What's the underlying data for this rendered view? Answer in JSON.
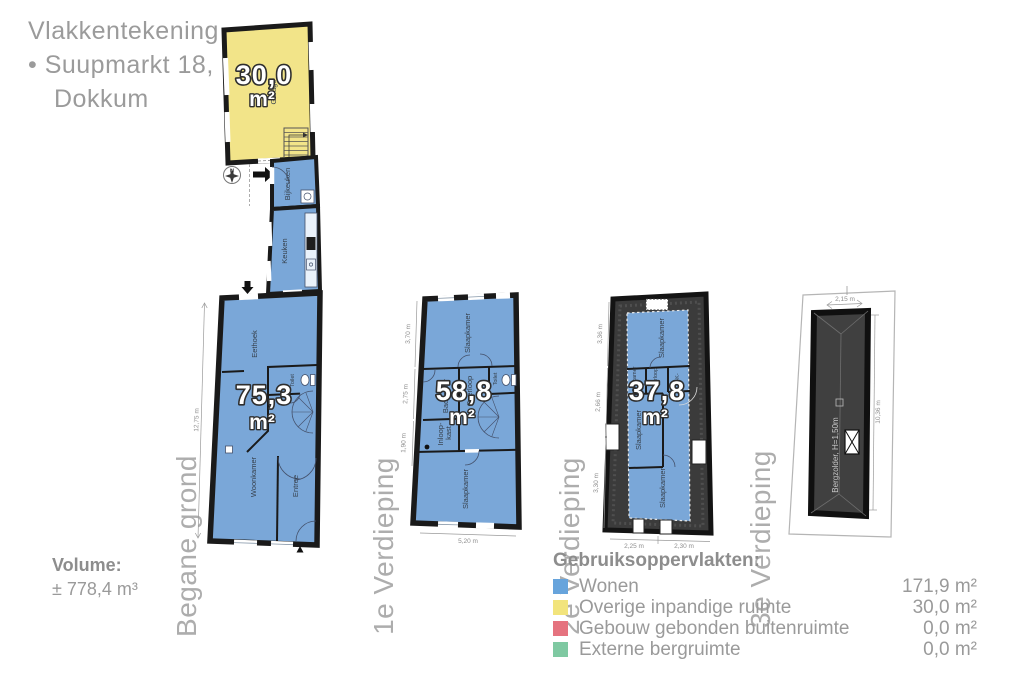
{
  "header": {
    "title": "Vlakkentekening",
    "address_line1": "• Suupmarkt 18,",
    "address_line2": "Dokkum"
  },
  "volume": {
    "label": "Volume:",
    "value": "± 778,4 m³"
  },
  "legend": {
    "heading": "Gebruiksoppervlakten:",
    "items": [
      {
        "label": "Wonen",
        "value": "171,9 m²",
        "color": "#67A4DC"
      },
      {
        "label": "Overige inpandige ruimte",
        "value": "30,0 m²",
        "color": "#F2E47C"
      },
      {
        "label": "Gebouw gebonden buitenruimte",
        "value": "0,0 m²",
        "color": "#E5737F"
      },
      {
        "label": "Externe bergruimte",
        "value": "0,0 m²",
        "color": "#7FC9A2"
      }
    ]
  },
  "floors": {
    "begane_grond": {
      "label": "Begane grond",
      "area": "75,3",
      "unit": "m²",
      "garage_area": "30,0",
      "garage_unit": "m²",
      "compass": "N",
      "rooms": {
        "garage": "Garage",
        "bijkeuken": "Bijkeuken",
        "keuken": "Keuken",
        "eethoek": "Eethoek",
        "hal": "Hal",
        "toilet": "Toilet",
        "woonkamer": "Woonkamer",
        "entree": "Entree"
      },
      "dims": {
        "left": "12,75 m"
      }
    },
    "verdieping1": {
      "label": "1e Verdieping",
      "area": "58,8",
      "unit": "m²",
      "rooms": {
        "slaapkamer_voor": "Slaapkamer",
        "badkamer": "Badkamer",
        "overloop": "Overloop",
        "toilet": "Toilet",
        "inloopkast_line1": "Inloop-",
        "inloopkast_line2": "kast",
        "slaapkamer_achter": "Slaapkamer"
      },
      "dims": {
        "left_top": "3,70 m",
        "left_mid": "2,75 m",
        "left_bottom": "1,90 m",
        "bottom": "5,20 m"
      }
    },
    "verdieping2": {
      "label": "2e Verdieping",
      "area": "37,8",
      "unit": "m²",
      "rooms": {
        "slaapkamer_voor": "Slaapkamer",
        "badkamer": "Badkamer",
        "overloop": "Overloop",
        "kast": "-K-",
        "slaapkamer_midden": "Slaapkamer",
        "slaapkamer_achter": "Slaapkamer"
      },
      "dims": {
        "left_top": "3,36 m",
        "left_mid": "2,66 m",
        "left_bottom": "3,30 m",
        "bottom_left": "2,25 m",
        "bottom_right": "2,30 m"
      }
    },
    "verdieping3": {
      "label": "3e Verdieping",
      "room": "Bergzolder, H=1,50m",
      "dims": {
        "top": "2,15 m",
        "right": "10,36 m"
      }
    }
  }
}
